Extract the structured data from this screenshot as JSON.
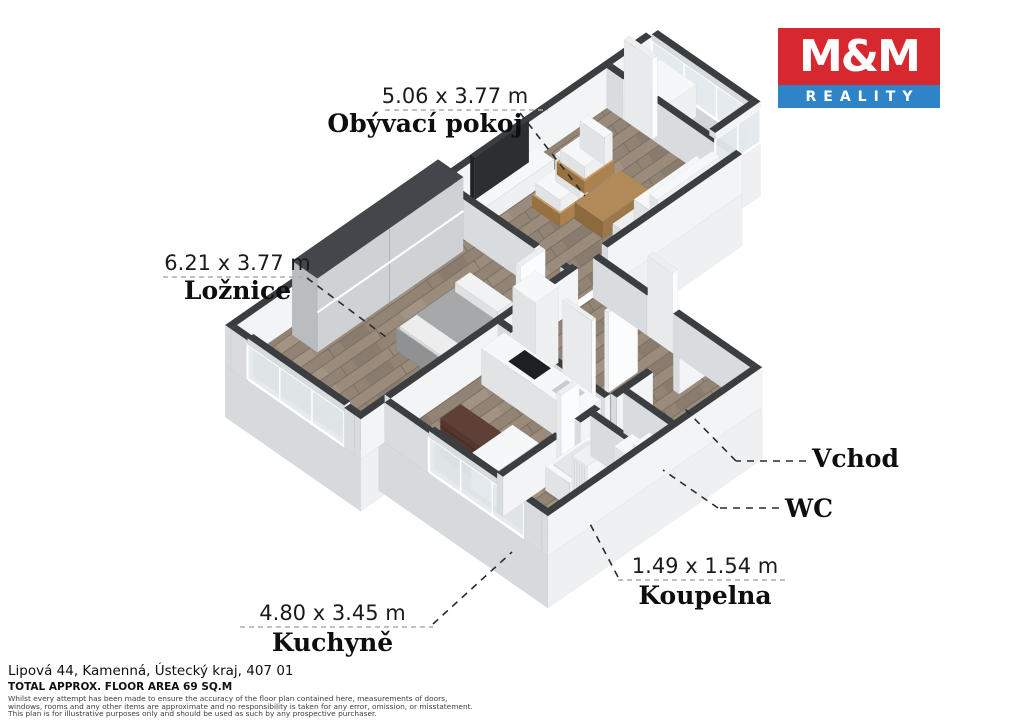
{
  "logo": {
    "top": "M&M",
    "bottom": "REALITY"
  },
  "plan_labels": {
    "living": {
      "dims": "5.06 x 3.77 m",
      "name": "Obývací pokoj"
    },
    "bedroom": {
      "dims": "6.21 x 3.77 m",
      "name": "Ložnice"
    },
    "kitchen": {
      "dims": "4.80 x 3.45 m",
      "name": "Kuchyně"
    },
    "bathroom": {
      "dims": "1.49 x 1.54 m",
      "name": "Koupelna"
    },
    "wc": {
      "name": "WC"
    },
    "entrance": {
      "name": "Vchod"
    }
  },
  "footer": {
    "address": "Lipová 44, Kamenná, Ústecký kraj, 407 01",
    "area": "TOTAL APPROX. FLOOR AREA 69 SQ.M",
    "disclaimer": [
      "Whilst every attempt has been made to ensure the accuracy of the floor plan contained here, measurements of doors,",
      "windows, rooms and any other items are approximate and no responsibility is taken for any error, omission, or misstatement.",
      "This plan is for illustrative purposes only and should be used as such by any prospective purchaser."
    ]
  },
  "colors": {
    "brand_red": "#d7282f",
    "brand_blue": "#2e84c6",
    "wall_cap": "#3b3e41",
    "wall_face_light": "#f3f4f5",
    "wall_face_shade": "#d9dcde",
    "slab_light": "#eef0f1",
    "slab_shade": "#d7dadc",
    "floor_wood": "#9a8b7b",
    "floor_wood_dark": "#8f8173",
    "balcony_floor": "#d3d5d7",
    "glass": "#e3eaed",
    "leader": "#2b2b2b",
    "underline": "#a8adb0"
  }
}
